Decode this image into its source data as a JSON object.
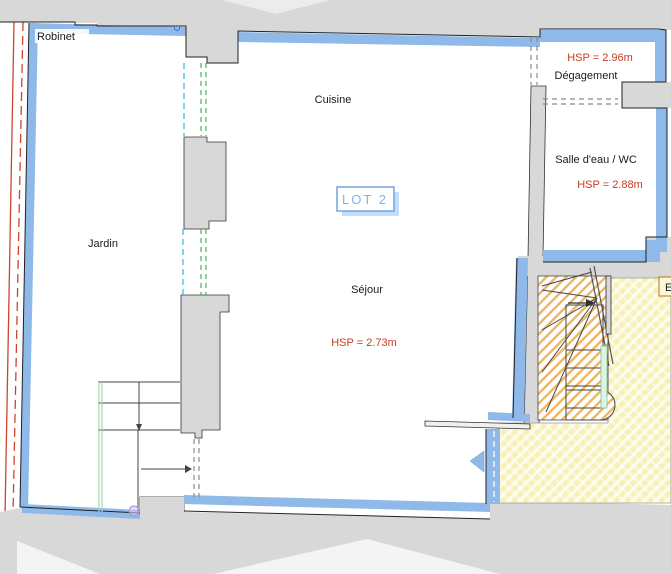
{
  "plan": {
    "lot_badge": "LOT 2",
    "rooms": {
      "jardin": {
        "label": "Jardin"
      },
      "cuisine": {
        "label": "Cuisine"
      },
      "sejour": {
        "label": "Séjour",
        "ceiling_height": "HSP = 2.73m"
      },
      "degagement": {
        "label": "Dégagement",
        "ceiling_height": "HSP = 2.96m"
      },
      "salle_eau": {
        "label": "Salle d'eau / WC",
        "ceiling_height": "HSP = 2.88m"
      }
    },
    "annotations": {
      "robinet": "Robinet",
      "stair_area_badge": "E"
    },
    "colors": {
      "wall_blue": "#8fb9e9",
      "outside_gray": "#d8d8d8",
      "hsp_red": "#c63c21",
      "lot_blue": "#7fb0f0",
      "stair_hatch_orange": "#e9a43c",
      "terrace_yellow": "#f7f1b5",
      "window_cyan": "#3fbcdc",
      "window_green": "#3aa94a",
      "boundary_red": "#cc4430",
      "door_dash_gray": "#8a8a8a",
      "glazing_pale_green": "#9fd8b0"
    }
  }
}
